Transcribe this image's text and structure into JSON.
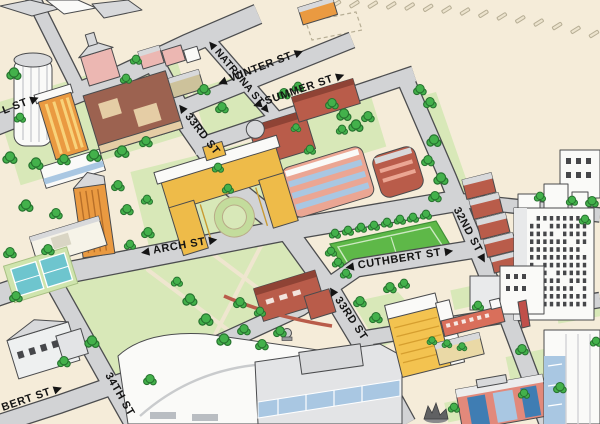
{
  "map": {
    "kind": "illustrated-campus-map",
    "streets": {
      "partial_left_top": {
        "name": "L ST",
        "display": "L ST ▶"
      },
      "winter": {
        "name": "WINTER ST",
        "display": "◀ WINTER ST ▶"
      },
      "natrona": {
        "name": "NATRONA ST",
        "display": "◀ NATRONA ST ▶"
      },
      "summer": {
        "name": "SUMMER ST",
        "display": "◀ SUMMER ST ▶"
      },
      "rd33_north": {
        "name": "33RD ST",
        "display": "◀ 33RD ST"
      },
      "rd33_south": {
        "name": "33RD ST",
        "display": "◀ 33RD ST"
      },
      "arch": {
        "name": "ARCH ST",
        "display": "◀ ARCH ST ▶"
      },
      "cuthbert": {
        "name": "CUTHBERT ST",
        "display": "◀ CUTHBERT ST ▶"
      },
      "rd32": {
        "name": "32ND ST",
        "display": "32ND ST ▶"
      },
      "rd34": {
        "name": "34TH ST",
        "display": "34TH ST"
      },
      "partial_left_bottom": {
        "name": "CUTHBERT ST",
        "display": "BERT ST ▶"
      }
    },
    "features": [
      "rail-line",
      "dashed-future-site",
      "round-tower",
      "orange-residence-tower",
      "chapel",
      "quad-courtyard-hall",
      "rowhouses",
      "turret-hall",
      "salmon-hall",
      "red-corner-hall",
      "arch-courtyard-building",
      "athletic-field",
      "tennis-courts",
      "rowhouses-32nd",
      "dorm-tower",
      "armory-hall",
      "dome-arena",
      "rec-hall",
      "randell-hall",
      "fin-tower",
      "white-courtyard-house",
      "yellow-midrise",
      "red-bridge-bar",
      "red-blue-hall",
      "glass-tower",
      "dragon-statue"
    ],
    "colors": {
      "paper": "#f5ecd9",
      "road": "#d2d3d5",
      "road_edge": "#4c4d4f",
      "edge": "#4a4b4d",
      "lawn": "#d8e8b8",
      "lawn2": "#c3dc9c",
      "field": "#5eb848",
      "field_line": "#cde9c2",
      "tree": "#43b14b",
      "tree_edge": "#27732f",
      "court": "#6ec5ce",
      "court_pad": "#cfe4ad",
      "brick": "#b95c4a",
      "brick_dark": "#8f4335",
      "salmon": "#eba693",
      "pink": "#ecb7b2",
      "orange": "#ea9a41",
      "yellow": "#eebb49",
      "gold": "#f3c350",
      "tan": "#e5cda5",
      "khaki": "#cdc29b",
      "white_building": "#fafaf8",
      "gray_roof": "#d8d9db",
      "glass": "#a9c7e2",
      "glass_dark": "#3f7db3",
      "window_dark": "#46474a",
      "label": "#141414",
      "path": "#efe6cf",
      "tick": "#b7ae95"
    }
  }
}
